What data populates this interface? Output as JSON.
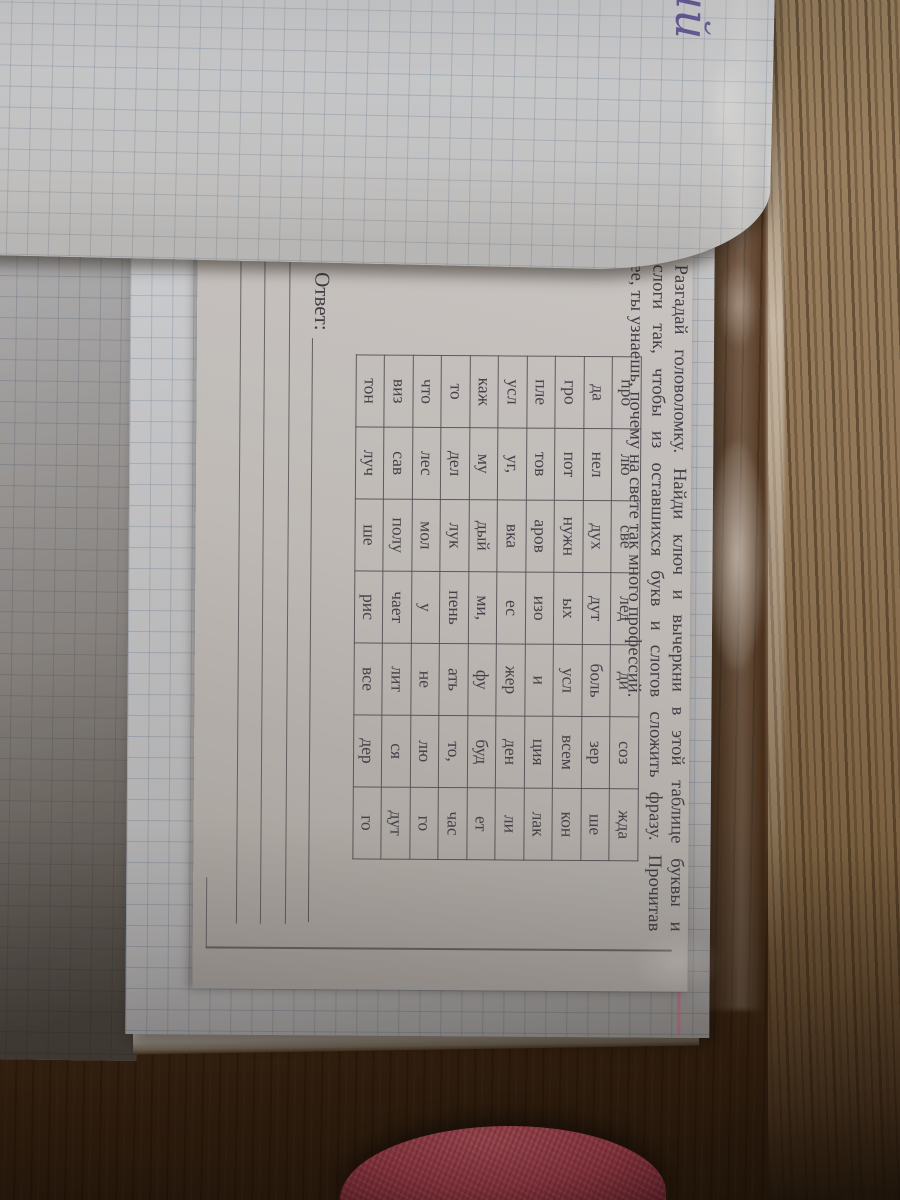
{
  "worksheet": {
    "instruction_lines": [
      "Разгадай головоломку. Найди ключ и вычеркни в этой таблице буквы и",
      "слоги так, чтобы из оставшихся букв и слогов сложить фразу. Прочитав",
      "ее, ты узнаешь, почему на свете так много профессий."
    ],
    "table_rows": [
      [
        "про",
        "лю",
        "све",
        "лед",
        "ди",
        "соз",
        "жда"
      ],
      [
        "да",
        "нел",
        "дух",
        "дут",
        "боль",
        "зер",
        "ше"
      ],
      [
        "гро",
        "пот",
        "нужн",
        "ых",
        "усл",
        "всем",
        "кон"
      ],
      [
        "пле",
        "тов",
        "аров",
        "изо",
        "и",
        "ция",
        "лак"
      ],
      [
        "усл",
        "уг,",
        "вка",
        "ес",
        "жер",
        "ден",
        "ли"
      ],
      [
        "каж",
        "му",
        "дый",
        "ми,",
        "фу",
        "буд",
        "ет"
      ],
      [
        "то",
        "дел",
        "лук",
        "пень",
        "ать",
        "то,",
        "час"
      ],
      [
        "что",
        "лес",
        "мол",
        "у",
        "не",
        "лю",
        "го"
      ],
      [
        "виз",
        "сав",
        "полу",
        "чает",
        "лит",
        "ся",
        "дут"
      ],
      [
        "тон",
        "луч",
        "ше",
        "рис",
        "все",
        "дер",
        "го"
      ]
    ],
    "answer_label": "Ответ:",
    "answer_line_count": 3
  },
  "handwriting": {
    "text": "ий"
  },
  "colors": {
    "print_ink": "#3e3d46",
    "handwriting_ink": "#5b4e9e",
    "margin_line_pink": "#ce5c80",
    "fabric_pink": "#ab4351",
    "paper_gray": "#c2bfbd",
    "wood_dark": "#432a16",
    "wood_light": "#93795a"
  }
}
